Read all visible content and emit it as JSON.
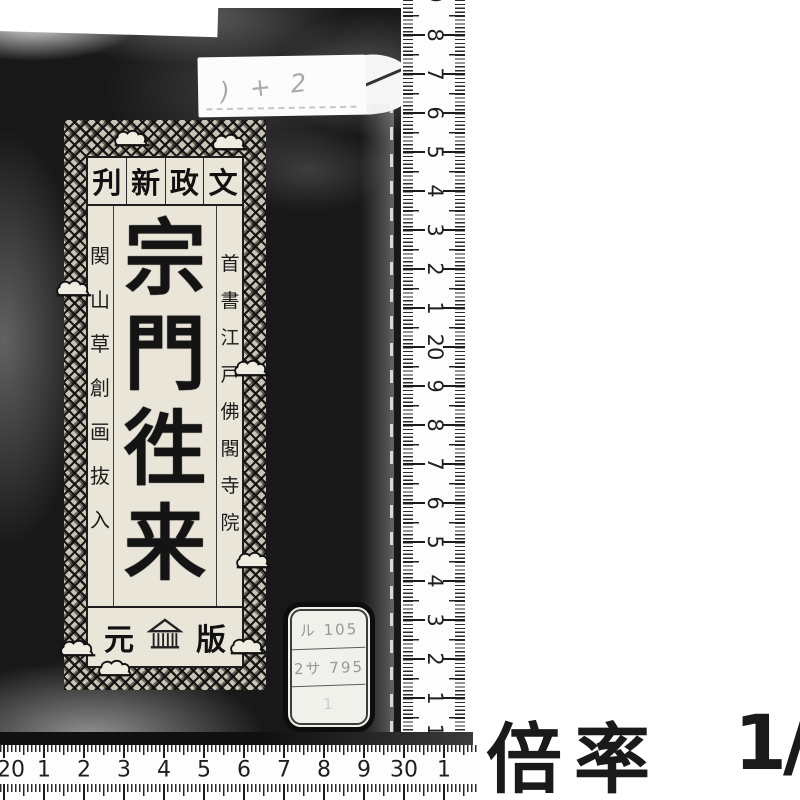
{
  "scan": {
    "magnification": {
      "label": "倍率",
      "value": "1",
      "separator": "/"
    }
  },
  "book": {
    "top_label": {
      "text": ") + 2"
    },
    "title_slip": {
      "era_header": {
        "text_rtl": "文政新刋",
        "chars": [
          "文",
          "政",
          "新",
          "刋"
        ]
      },
      "title": {
        "text": "宗門徃来",
        "chars": [
          "宗",
          "門",
          "徃",
          "来"
        ]
      },
      "right_note": {
        "text": "首書江戸佛閣寺院",
        "chars": [
          "首",
          "書",
          "江",
          "戸",
          "佛",
          "閣",
          "寺",
          "院"
        ]
      },
      "left_note": {
        "text": "関山草創画抜入",
        "chars": [
          "関",
          "山",
          "草",
          "創",
          "画",
          "抜",
          "入"
        ]
      },
      "publisher": {
        "left_char": "元",
        "right_char": "版",
        "mark": "storehouse-seal"
      }
    },
    "call_number_label": {
      "rows": [
        "ル 105",
        "2サ 795",
        "1"
      ]
    }
  },
  "rulers": {
    "vertical": {
      "unit": "cm",
      "numbers": [
        "9",
        "8",
        "7",
        "6",
        "5",
        "4",
        "3",
        "2",
        "1",
        "20",
        "9",
        "8",
        "7",
        "6",
        "5",
        "4",
        "3",
        "2",
        "1",
        "10"
      ],
      "positions_y": [
        -4,
        35,
        74,
        113,
        152,
        191,
        230,
        269,
        308,
        347,
        386,
        425,
        464,
        503,
        542,
        581,
        620,
        659,
        698,
        737
      ]
    },
    "horizontal": {
      "unit": "cm",
      "numbers": [
        "20",
        "1",
        "2",
        "3",
        "4",
        "5",
        "6",
        "7",
        "8",
        "9",
        "30",
        "1"
      ],
      "positions_x": [
        11,
        44,
        84,
        124,
        164,
        204,
        244,
        284,
        324,
        364,
        404,
        444
      ]
    }
  }
}
